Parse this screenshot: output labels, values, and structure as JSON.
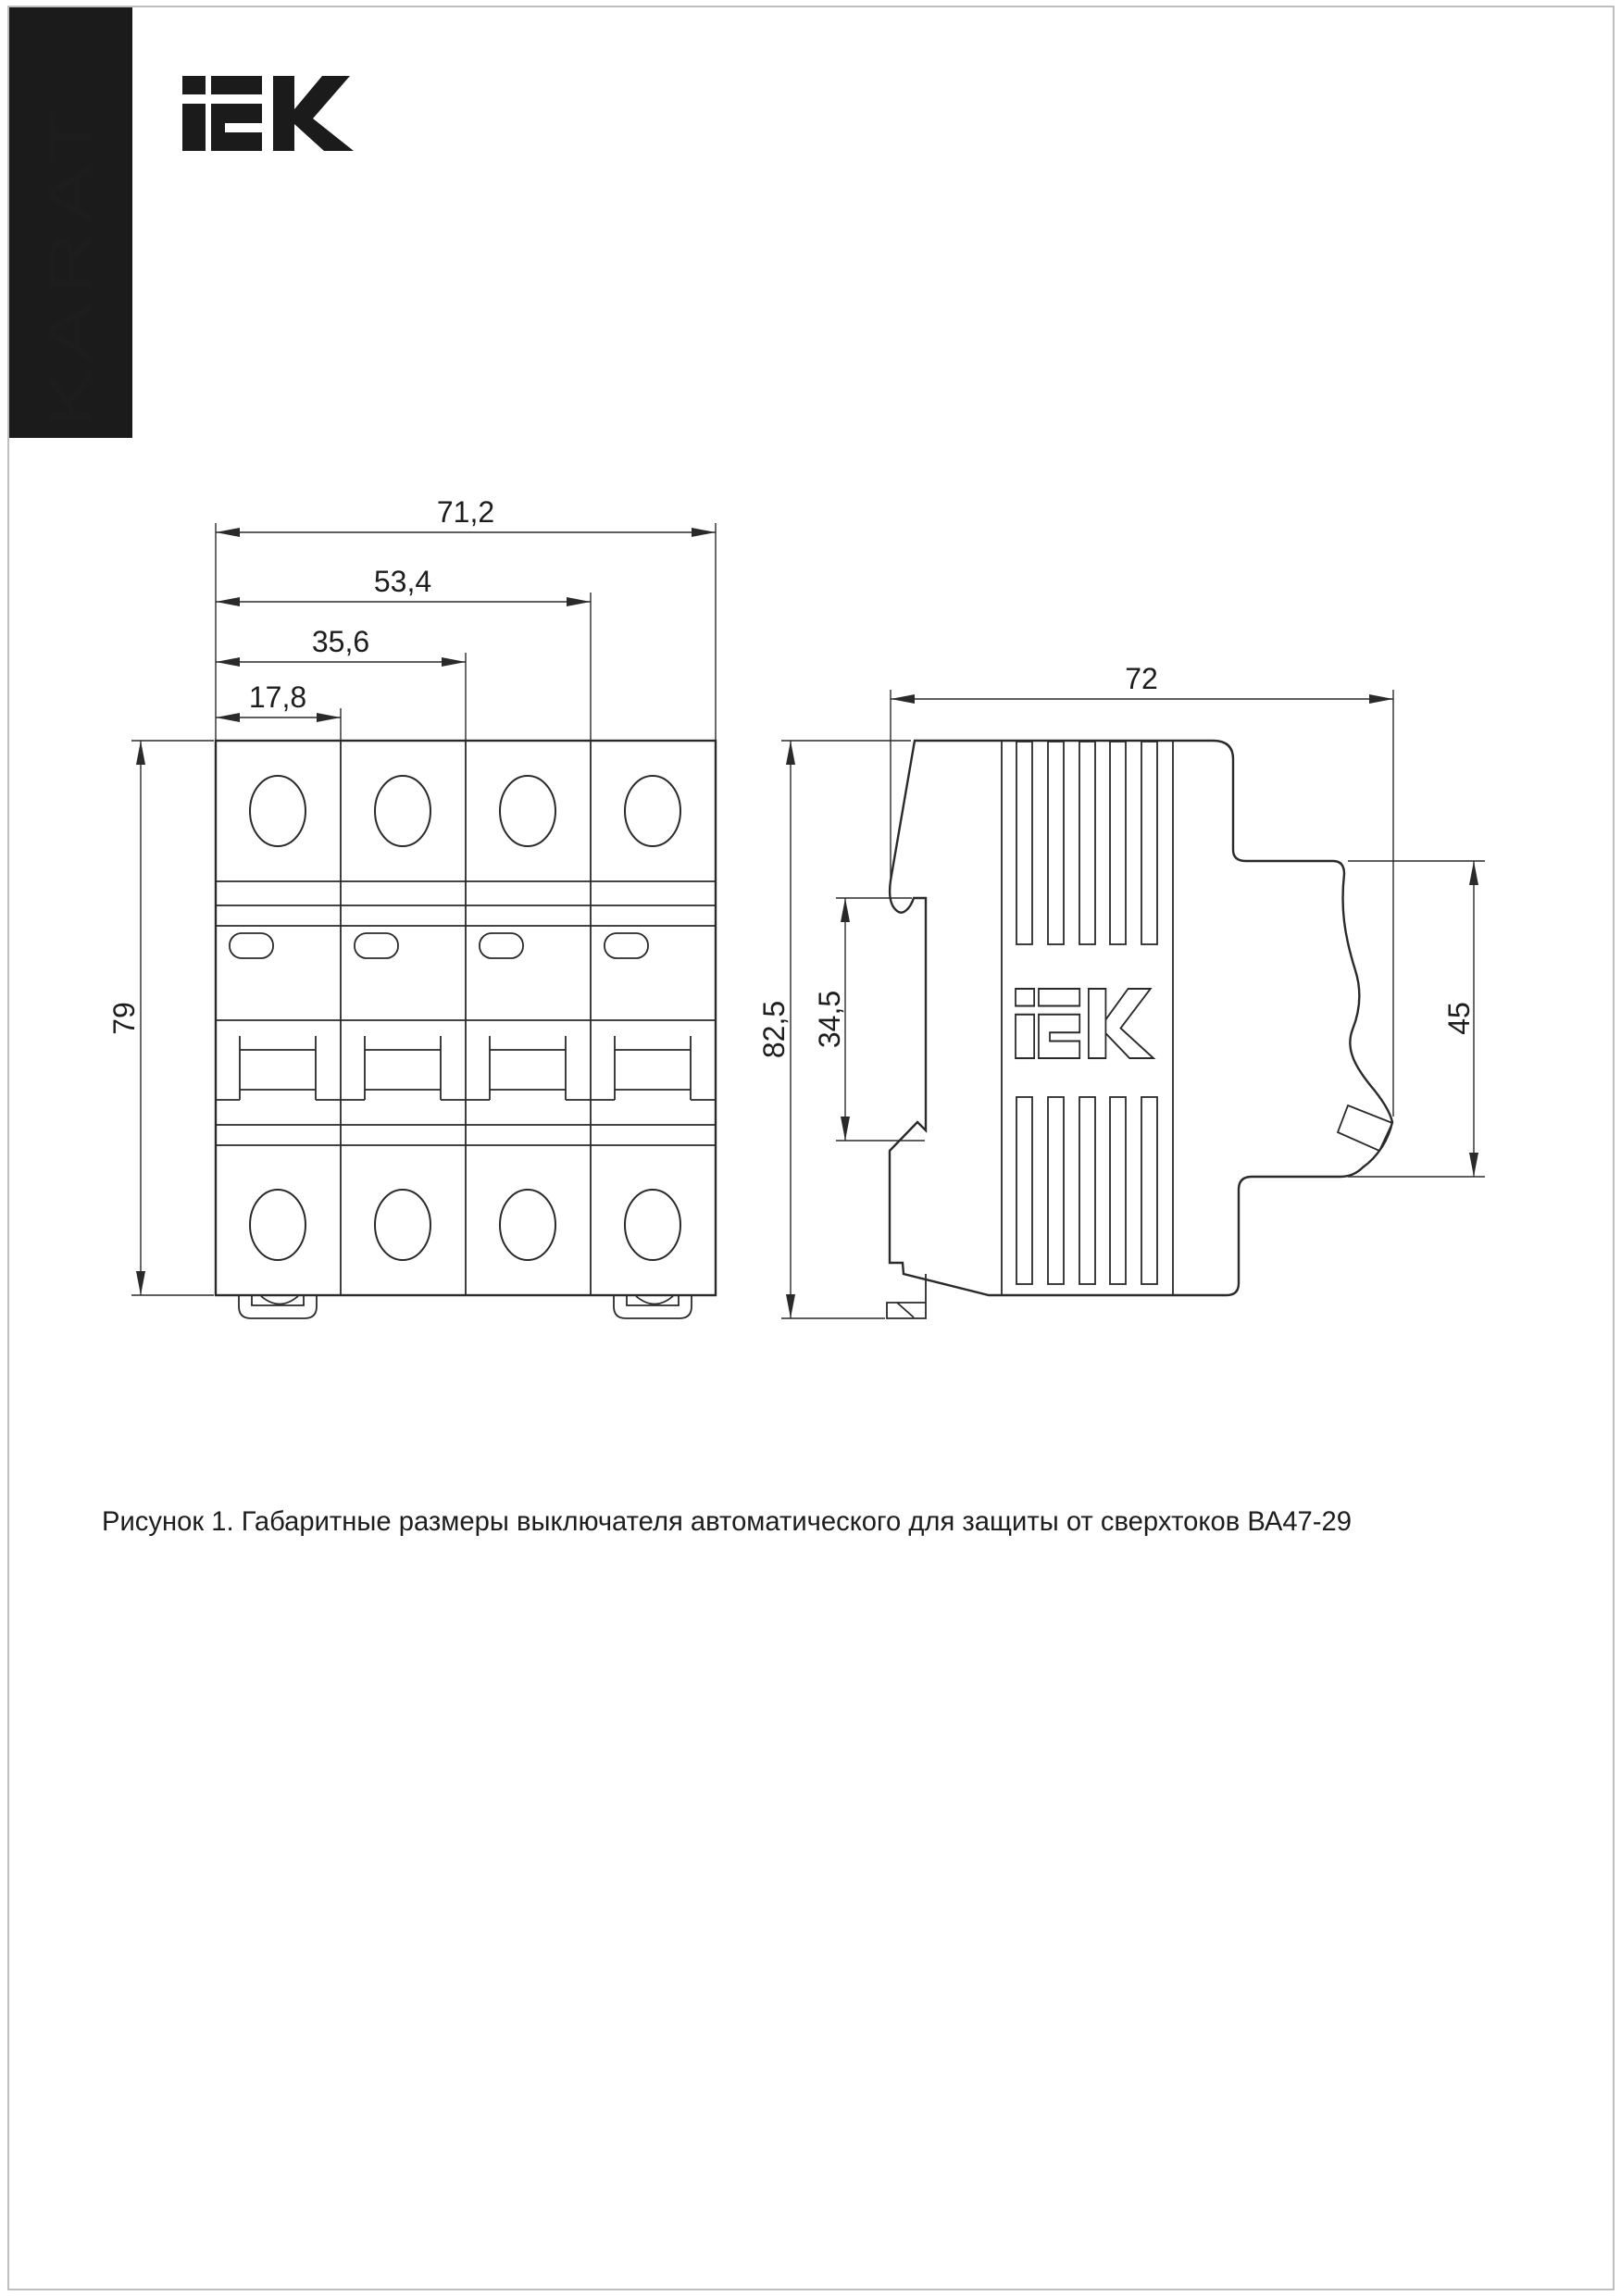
{
  "colors": {
    "ink": "#2a2a2a",
    "brand_bar_bg": "#1b1b1b",
    "brand_text": "#ffffff",
    "page_edge": "#a8a8a8"
  },
  "brand_bar": {
    "label": "KARAT"
  },
  "logo": {
    "text": "iEK"
  },
  "figure": {
    "caption": "Рисунок 1. Габаритные размеры выключателя автоматического для защиты от сверхтоков ВА47-29",
    "front_view": {
      "dims": {
        "overall_width": "71,2",
        "three_modules": "53,4",
        "two_modules": "35,6",
        "one_module": "17,8",
        "overall_height": "79"
      }
    },
    "side_view": {
      "dims": {
        "overall_depth": "72",
        "overall_height": "82,5",
        "din_rail_zone": "34,5",
        "front_depth": "45"
      }
    }
  }
}
